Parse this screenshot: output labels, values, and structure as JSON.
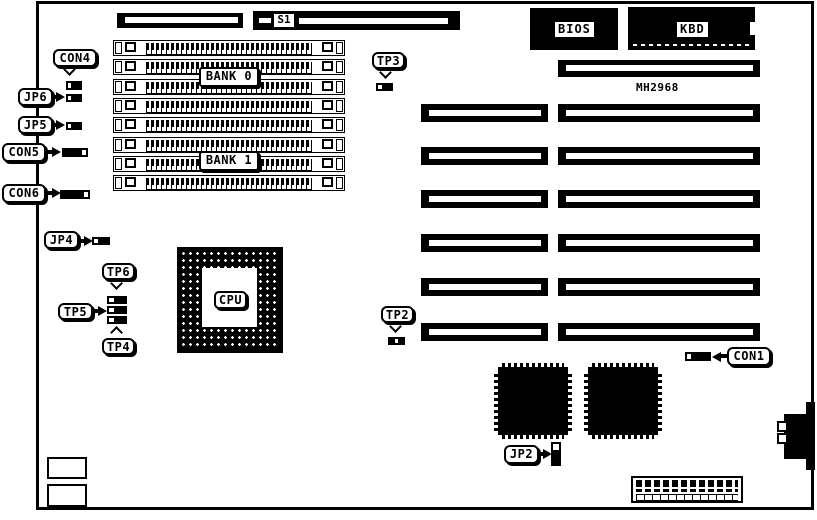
{
  "diagram": {
    "kind": "motherboard-jumper-connector-diagram",
    "colors": {
      "ink": "#000000",
      "paper": "#ffffff"
    }
  },
  "labels": {
    "s1": "S1",
    "bios": "BIOS",
    "kbd": "KBD",
    "mh2968": "MH2968",
    "bank0": "BANK 0",
    "bank1": "BANK 1",
    "cpu": "CPU",
    "con4": "CON4",
    "con5": "CON5",
    "con6": "CON6",
    "con1": "CON1",
    "jp6": "JP6",
    "jp5": "JP5",
    "jp4": "JP4",
    "jp2": "JP2",
    "tp6": "TP6",
    "tp5": "TP5",
    "tp4": "TP4",
    "tp3": "TP3",
    "tp2": "TP2"
  }
}
